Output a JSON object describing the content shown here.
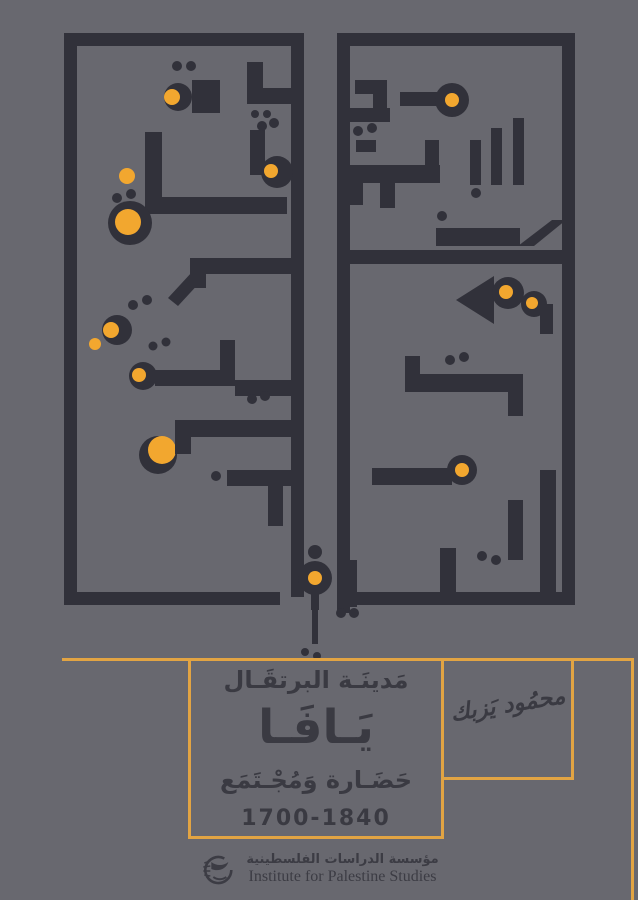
{
  "cover": {
    "background": "#68686f",
    "ink": "#31313a",
    "accent": "#f2a72f",
    "rule_color": "#e2a443",
    "text_color": "#3a3a42",
    "description": "Book cover: geometric Kufic calligraphy panel above, title panel below"
  },
  "title_block": {
    "line1": "مَدينَـة البرتقَـال",
    "title": "يَـافَـا",
    "line3": "حَضَـارة وَمُجْـتَمَع",
    "years": "1700-1840"
  },
  "author": {
    "name": "محمُود يَزبك"
  },
  "publisher": {
    "arabic": "مؤسسة الدراسات الفلسطينية",
    "english": "Institute for Palestine Studies"
  },
  "rules": [
    {
      "x": 62,
      "y": 658,
      "w": 571,
      "h": 3
    },
    {
      "x": 188,
      "y": 658,
      "w": 3,
      "h": 181
    },
    {
      "x": 441,
      "y": 658,
      "w": 3,
      "h": 181
    },
    {
      "x": 188,
      "y": 836,
      "w": 256,
      "h": 3
    },
    {
      "x": 571,
      "y": 658,
      "w": 3,
      "h": 122
    },
    {
      "x": 441,
      "y": 777,
      "w": 133,
      "h": 3
    },
    {
      "x": 631,
      "y": 658,
      "w": 3,
      "h": 242
    }
  ],
  "artwork": {
    "shapes": [
      {
        "t": "r",
        "x": 64,
        "y": 33,
        "w": 240,
        "h": 13
      },
      {
        "t": "r",
        "x": 64,
        "y": 33,
        "w": 13,
        "h": 572
      },
      {
        "t": "r",
        "x": 64,
        "y": 592,
        "w": 216,
        "h": 13
      },
      {
        "t": "r",
        "x": 291,
        "y": 33,
        "w": 13,
        "h": 564
      },
      {
        "t": "r",
        "x": 337,
        "y": 33,
        "w": 238,
        "h": 13
      },
      {
        "t": "r",
        "x": 337,
        "y": 33,
        "w": 13,
        "h": 580
      },
      {
        "t": "r",
        "x": 562,
        "y": 33,
        "w": 13,
        "h": 572
      },
      {
        "t": "r",
        "x": 355,
        "y": 592,
        "w": 220,
        "h": 13
      },
      {
        "t": "c",
        "cx": 178,
        "cy": 97,
        "r": 14
      },
      {
        "t": "y",
        "cx": 172,
        "cy": 97,
        "r": 8
      },
      {
        "t": "c",
        "cx": 177,
        "cy": 66,
        "r": 5
      },
      {
        "t": "c",
        "cx": 191,
        "cy": 66,
        "r": 5
      },
      {
        "t": "r",
        "x": 192,
        "y": 80,
        "w": 28,
        "h": 33
      },
      {
        "t": "r",
        "x": 247,
        "y": 62,
        "w": 16,
        "h": 28
      },
      {
        "t": "r",
        "x": 247,
        "y": 88,
        "w": 44,
        "h": 16
      },
      {
        "t": "c",
        "cx": 255,
        "cy": 114,
        "r": 4
      },
      {
        "t": "c",
        "cx": 267,
        "cy": 114,
        "r": 4
      },
      {
        "t": "y",
        "cx": 127,
        "cy": 176,
        "r": 8
      },
      {
        "t": "r",
        "x": 145,
        "y": 132,
        "w": 17,
        "h": 82
      },
      {
        "t": "r",
        "x": 145,
        "y": 197,
        "w": 142,
        "h": 17
      },
      {
        "t": "r",
        "x": 250,
        "y": 130,
        "w": 15,
        "h": 45
      },
      {
        "t": "c",
        "cx": 262,
        "cy": 126,
        "r": 5
      },
      {
        "t": "c",
        "cx": 274,
        "cy": 123,
        "r": 5
      },
      {
        "t": "c",
        "cx": 277,
        "cy": 172,
        "r": 16
      },
      {
        "t": "y",
        "cx": 271,
        "cy": 171,
        "r": 7
      },
      {
        "t": "c",
        "cx": 130,
        "cy": 223,
        "r": 22
      },
      {
        "t": "y",
        "cx": 128,
        "cy": 222,
        "r": 13
      },
      {
        "t": "c",
        "cx": 117,
        "cy": 198,
        "r": 5
      },
      {
        "t": "c",
        "cx": 131,
        "cy": 194,
        "r": 5
      },
      {
        "t": "r",
        "x": 190,
        "y": 258,
        "w": 101,
        "h": 16
      },
      {
        "t": "r",
        "x": 190,
        "y": 258,
        "w": 16,
        "h": 30
      },
      {
        "t": "p",
        "pts": "168,298 192,272 202,280 178,306"
      },
      {
        "t": "c",
        "cx": 117,
        "cy": 330,
        "r": 15
      },
      {
        "t": "y",
        "cx": 111,
        "cy": 330,
        "r": 8
      },
      {
        "t": "y",
        "cx": 95,
        "cy": 344,
        "r": 6
      },
      {
        "t": "c",
        "cx": 133,
        "cy": 305,
        "r": 5
      },
      {
        "t": "c",
        "cx": 147,
        "cy": 300,
        "r": 5
      },
      {
        "t": "c",
        "cx": 143,
        "cy": 376,
        "r": 14
      },
      {
        "t": "y",
        "cx": 139,
        "cy": 375,
        "r": 7
      },
      {
        "t": "c",
        "cx": 153,
        "cy": 346,
        "r": 4.5
      },
      {
        "t": "c",
        "cx": 166,
        "cy": 342,
        "r": 4.5
      },
      {
        "t": "r",
        "x": 155,
        "y": 370,
        "w": 80,
        "h": 16
      },
      {
        "t": "r",
        "x": 220,
        "y": 340,
        "w": 15,
        "h": 32
      },
      {
        "t": "r",
        "x": 235,
        "y": 380,
        "w": 56,
        "h": 16
      },
      {
        "t": "c",
        "cx": 158,
        "cy": 455,
        "r": 19
      },
      {
        "t": "y",
        "cx": 162,
        "cy": 450,
        "r": 14
      },
      {
        "t": "r",
        "x": 175,
        "y": 420,
        "w": 116,
        "h": 17
      },
      {
        "t": "r",
        "x": 175,
        "y": 420,
        "w": 16,
        "h": 34
      },
      {
        "t": "c",
        "cx": 252,
        "cy": 399,
        "r": 5
      },
      {
        "t": "c",
        "cx": 265,
        "cy": 396,
        "r": 5
      },
      {
        "t": "r",
        "x": 227,
        "y": 470,
        "w": 64,
        "h": 16
      },
      {
        "t": "c",
        "cx": 216,
        "cy": 476,
        "r": 5
      },
      {
        "t": "r",
        "x": 268,
        "y": 486,
        "w": 15,
        "h": 40
      },
      {
        "t": "r",
        "x": 355,
        "y": 80,
        "w": 32,
        "h": 14
      },
      {
        "t": "r",
        "x": 373,
        "y": 80,
        "w": 14,
        "h": 32
      },
      {
        "t": "r",
        "x": 346,
        "y": 108,
        "w": 44,
        "h": 14
      },
      {
        "t": "r",
        "x": 400,
        "y": 92,
        "w": 38,
        "h": 14
      },
      {
        "t": "c",
        "cx": 452,
        "cy": 100,
        "r": 17
      },
      {
        "t": "y",
        "cx": 452,
        "cy": 100,
        "r": 7
      },
      {
        "t": "c",
        "cx": 358,
        "cy": 131,
        "r": 5
      },
      {
        "t": "c",
        "cx": 372,
        "cy": 128,
        "r": 5
      },
      {
        "t": "r",
        "x": 356,
        "y": 140,
        "w": 20,
        "h": 12
      },
      {
        "t": "r",
        "x": 470,
        "y": 140,
        "w": 11,
        "h": 45
      },
      {
        "t": "r",
        "x": 491,
        "y": 128,
        "w": 11,
        "h": 57
      },
      {
        "t": "r",
        "x": 513,
        "y": 118,
        "w": 11,
        "h": 67
      },
      {
        "t": "c",
        "cx": 476,
        "cy": 193,
        "r": 5
      },
      {
        "t": "r",
        "x": 350,
        "y": 165,
        "w": 90,
        "h": 18
      },
      {
        "t": "r",
        "x": 350,
        "y": 165,
        "w": 13,
        "h": 40
      },
      {
        "t": "r",
        "x": 380,
        "y": 183,
        "w": 15,
        "h": 25
      },
      {
        "t": "r",
        "x": 425,
        "y": 140,
        "w": 14,
        "h": 43
      },
      {
        "t": "c",
        "cx": 442,
        "cy": 216,
        "r": 5
      },
      {
        "t": "r",
        "x": 436,
        "y": 228,
        "w": 12,
        "h": 18
      },
      {
        "t": "r",
        "x": 448,
        "y": 228,
        "w": 72,
        "h": 18
      },
      {
        "t": "p",
        "pts": "518,246 552,220 566,220 534,246"
      },
      {
        "t": "r",
        "x": 350,
        "y": 250,
        "w": 212,
        "h": 14
      },
      {
        "t": "p",
        "pts": "456,300 494,276 494,324"
      },
      {
        "t": "c",
        "cx": 508,
        "cy": 293,
        "r": 16
      },
      {
        "t": "y",
        "cx": 506,
        "cy": 292,
        "r": 7
      },
      {
        "t": "c",
        "cx": 534,
        "cy": 304,
        "r": 13
      },
      {
        "t": "y",
        "cx": 532,
        "cy": 303,
        "r": 6
      },
      {
        "t": "r",
        "x": 540,
        "y": 304,
        "w": 13,
        "h": 30
      },
      {
        "t": "r",
        "x": 405,
        "y": 356,
        "w": 15,
        "h": 18
      },
      {
        "t": "r",
        "x": 405,
        "y": 374,
        "w": 118,
        "h": 18
      },
      {
        "t": "r",
        "x": 508,
        "y": 392,
        "w": 15,
        "h": 24
      },
      {
        "t": "c",
        "cx": 450,
        "cy": 360,
        "r": 5
      },
      {
        "t": "c",
        "cx": 464,
        "cy": 357,
        "r": 5
      },
      {
        "t": "c",
        "cx": 462,
        "cy": 470,
        "r": 15
      },
      {
        "t": "y",
        "cx": 462,
        "cy": 470,
        "r": 7
      },
      {
        "t": "r",
        "x": 372,
        "y": 468,
        "w": 80,
        "h": 17
      },
      {
        "t": "r",
        "x": 540,
        "y": 470,
        "w": 16,
        "h": 122
      },
      {
        "t": "r",
        "x": 508,
        "y": 500,
        "w": 15,
        "h": 60
      },
      {
        "t": "c",
        "cx": 496,
        "cy": 560,
        "r": 5
      },
      {
        "t": "c",
        "cx": 482,
        "cy": 556,
        "r": 5
      },
      {
        "t": "r",
        "x": 440,
        "y": 548,
        "w": 16,
        "h": 44
      },
      {
        "t": "c",
        "cx": 315,
        "cy": 578,
        "r": 17
      },
      {
        "t": "y",
        "cx": 315,
        "cy": 578,
        "r": 7
      },
      {
        "t": "c",
        "cx": 315,
        "cy": 552,
        "r": 7
      },
      {
        "t": "r",
        "x": 311,
        "y": 594,
        "w": 8,
        "h": 16
      },
      {
        "t": "r",
        "x": 312,
        "y": 608,
        "w": 6,
        "h": 36
      },
      {
        "t": "c",
        "cx": 305,
        "cy": 652,
        "r": 4
      },
      {
        "t": "c",
        "cx": 317,
        "cy": 656,
        "r": 4
      },
      {
        "t": "r",
        "x": 337,
        "y": 560,
        "w": 20,
        "h": 47
      },
      {
        "t": "c",
        "cx": 341,
        "cy": 613,
        "r": 5
      },
      {
        "t": "c",
        "cx": 354,
        "cy": 613,
        "r": 5
      },
      {
        "t": "r",
        "x": 365,
        "y": 594,
        "w": 26,
        "h": 11
      }
    ]
  }
}
